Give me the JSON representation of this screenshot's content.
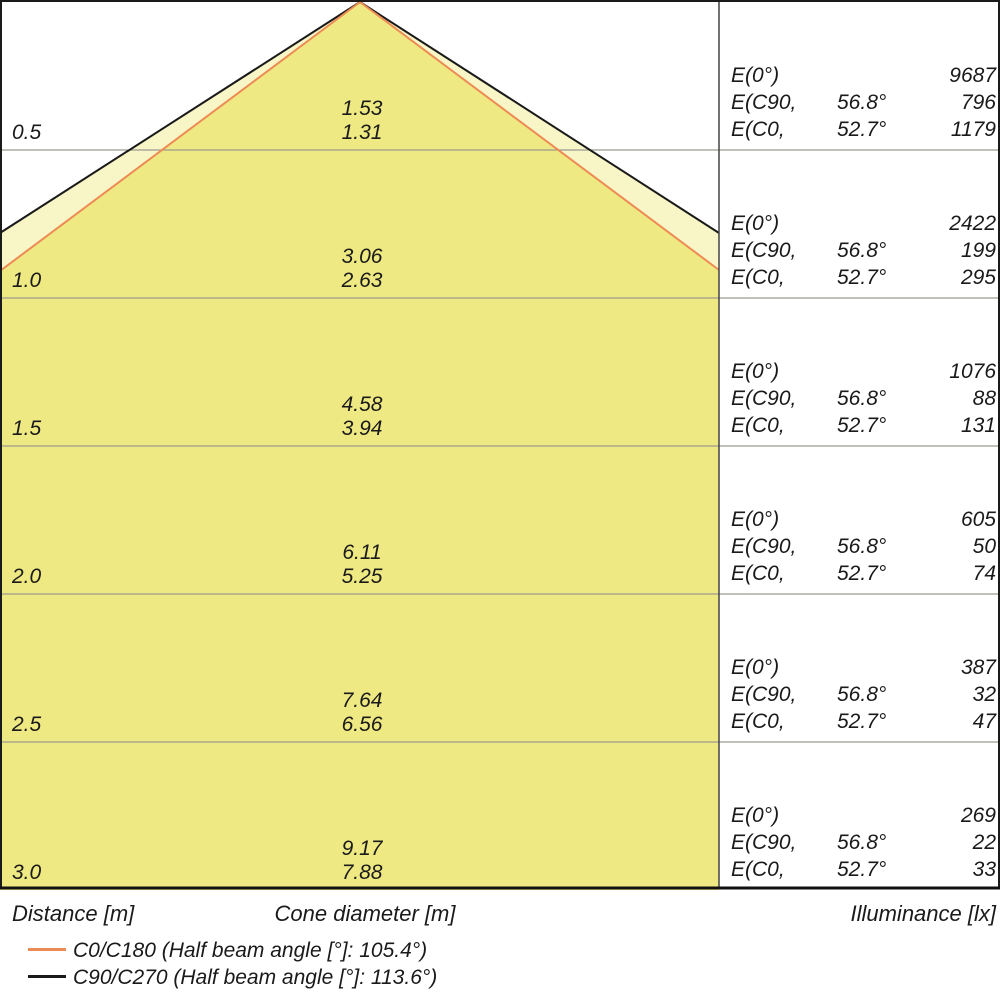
{
  "colors": {
    "beam_outer_fill": "#F8F5C6",
    "beam_inner_fill": "#EFE983",
    "c0_line": "#ED8B55",
    "c90_line": "#1A1A1A",
    "grid_line": "#9B9B8F"
  },
  "footer": {
    "distance_label": "Distance [m]",
    "cone_diameter_label": "Cone diameter [m]",
    "illuminance_label": "Illuminance [lx]"
  },
  "legend": {
    "c0": {
      "label": "C0/C180 (Half beam angle [°]: 105.4°)",
      "color": "#ED8B55"
    },
    "c90": {
      "label": "C90/C270 (Half beam angle [°]: 113.6°)",
      "color": "#1A1A1A"
    }
  },
  "rows": [
    {
      "distance": "0.5",
      "cone_c90": "1.53",
      "cone_c0": "1.31",
      "e0_label": "E(0°)",
      "e0": "9687",
      "ec90_label": "E(C90,",
      "ec90_angle": "56.8°",
      "ec90": "796",
      "ec0_label": "E(C0,",
      "ec0_angle": "52.7°",
      "ec0": "1179"
    },
    {
      "distance": "1.0",
      "cone_c90": "3.06",
      "cone_c0": "2.63",
      "e0_label": "E(0°)",
      "e0": "2422",
      "ec90_label": "E(C90,",
      "ec90_angle": "56.8°",
      "ec90": "199",
      "ec0_label": "E(C0,",
      "ec0_angle": "52.7°",
      "ec0": "295"
    },
    {
      "distance": "1.5",
      "cone_c90": "4.58",
      "cone_c0": "3.94",
      "e0_label": "E(0°)",
      "e0": "1076",
      "ec90_label": "E(C90,",
      "ec90_angle": "56.8°",
      "ec90": "88",
      "ec0_label": "E(C0,",
      "ec0_angle": "52.7°",
      "ec0": "131"
    },
    {
      "distance": "2.0",
      "cone_c90": "6.11",
      "cone_c0": "5.25",
      "e0_label": "E(0°)",
      "e0": "605",
      "ec90_label": "E(C90,",
      "ec90_angle": "56.8°",
      "ec90": "50",
      "ec0_label": "E(C0,",
      "ec0_angle": "52.7°",
      "ec0": "74"
    },
    {
      "distance": "2.5",
      "cone_c90": "7.64",
      "cone_c0": "6.56",
      "e0_label": "E(0°)",
      "e0": "387",
      "ec90_label": "E(C90,",
      "ec90_angle": "56.8°",
      "ec90": "32",
      "ec0_label": "E(C0,",
      "ec0_angle": "52.7°",
      "ec0": "47"
    },
    {
      "distance": "3.0",
      "cone_c90": "9.17",
      "cone_c0": "7.88",
      "e0_label": "E(0°)",
      "e0": "269",
      "ec90_label": "E(C90,",
      "ec90_angle": "56.8°",
      "ec90": "22",
      "ec0_label": "E(C0,",
      "ec0_angle": "52.7°",
      "ec0": "33"
    }
  ],
  "chart_data": {
    "type": "table",
    "subtype": "photometric-light-cone-diagram",
    "distance_m": [
      0.5,
      1.0,
      1.5,
      2.0,
      2.5,
      3.0
    ],
    "series": [
      {
        "name": "Cone diameter C90/C270 [m]",
        "values": [
          1.53,
          3.06,
          4.58,
          6.11,
          7.64,
          9.17
        ]
      },
      {
        "name": "Cone diameter C0/C180 [m]",
        "values": [
          1.31,
          2.63,
          3.94,
          5.25,
          6.56,
          7.88
        ]
      },
      {
        "name": "E(0°) [lx]",
        "values": [
          9687,
          2422,
          1076,
          605,
          387,
          269
        ]
      },
      {
        "name": "E(C90, 56.8°) [lx]",
        "values": [
          796,
          199,
          88,
          50,
          32,
          22
        ]
      },
      {
        "name": "E(C0, 52.7°) [lx]",
        "values": [
          1179,
          295,
          131,
          74,
          47,
          33
        ]
      }
    ],
    "half_beam_angle_deg": {
      "C0/C180": 105.4,
      "C90/C270": 113.6
    },
    "axes": {
      "left": "Distance [m]",
      "center": "Cone diameter [m]",
      "right": "Illuminance [lx]"
    },
    "legend_position": "bottom-left",
    "grid": true
  }
}
